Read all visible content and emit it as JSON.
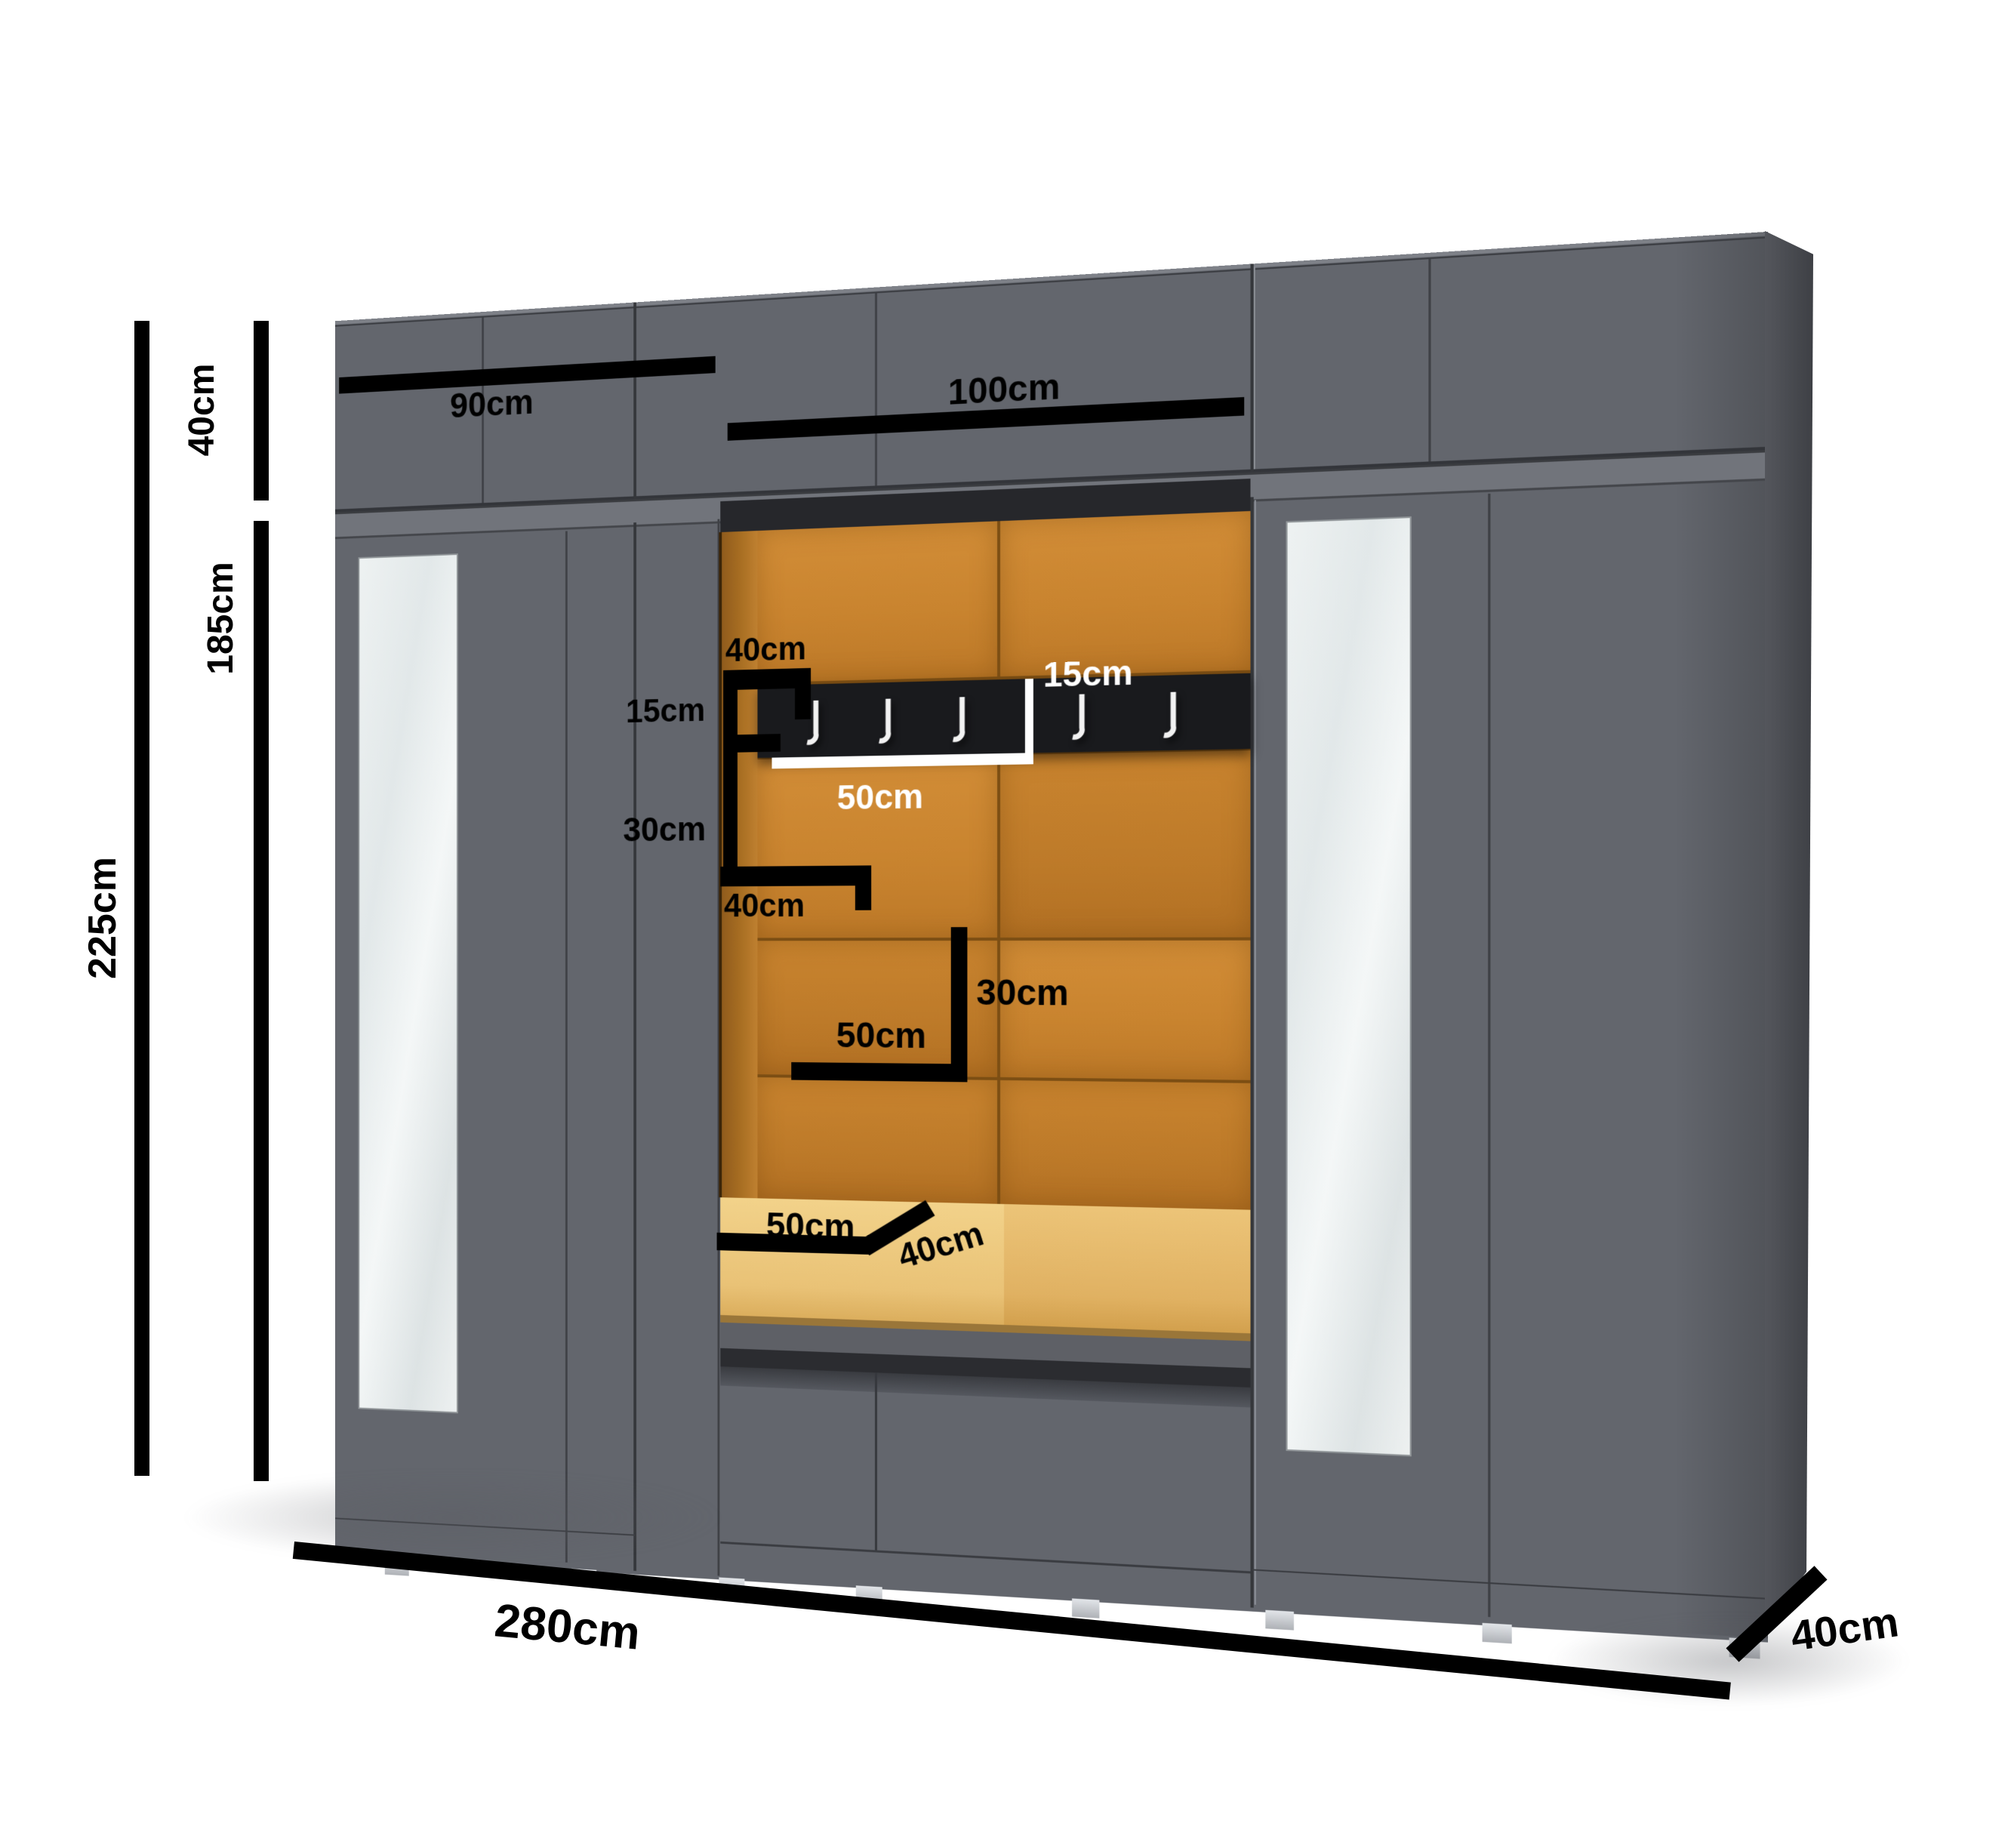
{
  "diagram": {
    "unit": "cm",
    "labels": {
      "top_section_height": "40cm",
      "lower_section_height": "185cm",
      "total_height": "225cm",
      "left_module_width": "90cm",
      "middle_module_width": "100cm",
      "total_width": "280cm",
      "cabinet_depth": "40cm",
      "niche_side_shelf_top_width": "40cm",
      "niche_side_gap_height": "15cm",
      "niche_side_shelf_height": "30cm",
      "niche_side_shelf_bottom_width": "40cm",
      "hook_rail_height": "15cm",
      "hook_rail_section_width": "50cm",
      "niche_shelf_width": "50cm",
      "niche_shelf_height": "30cm",
      "seat_width": "50cm",
      "seat_depth": "40cm"
    },
    "hooks": {
      "count": 5,
      "left_group": 3,
      "right_group": 2
    },
    "colors": {
      "background": "#ffffff",
      "cabinet_front": "#63666d",
      "cabinet_side": "#45474d",
      "niche_upholstery": "#c9842f",
      "niche_side_wall": "#a86e22",
      "seat_cushion": "#e9c276",
      "hook_rail": "#191a1d",
      "dimension_marks": "#000000",
      "inner_marks_light": "#ffffff",
      "mirror": "#e9eded"
    }
  }
}
